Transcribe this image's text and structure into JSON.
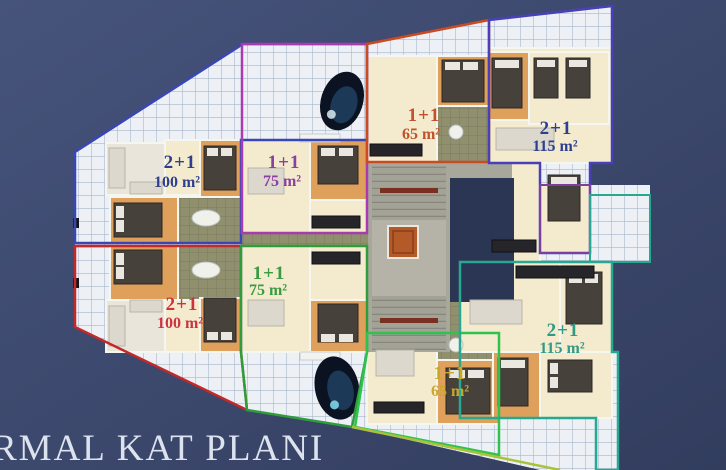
{
  "title": "RMAL KAT PLANI",
  "plan": {
    "units": [
      {
        "id": "top-left",
        "type": "2+1",
        "area": "100 m²",
        "label_color": "#2e3f8f",
        "outline_color": "#3847b5"
      },
      {
        "id": "top-mid-left",
        "type": "1+1",
        "area": "75 m²",
        "label_color": "#8b3fa0",
        "outline_color": "#a83bb0"
      },
      {
        "id": "top-mid-right",
        "type": "1+1",
        "area": "65 m²",
        "label_color": "#c0512a",
        "outline_color": "#cc4a22"
      },
      {
        "id": "top-right",
        "type": "2+1",
        "area": "115 m²",
        "label_color": "#2e3f8f",
        "outline_color": "#4840b8"
      },
      {
        "id": "bottom-left",
        "type": "2+1",
        "area": "100 m²",
        "label_color": "#cc3340",
        "outline_color": "#c42828"
      },
      {
        "id": "bottom-mid-left",
        "type": "1+1",
        "area": "75 m²",
        "label_color": "#3a9a40",
        "outline_color": "#2f9e3a"
      },
      {
        "id": "bottom-mid-right",
        "type": "1+1",
        "area": "65 m²",
        "label_color": "#c8a828",
        "outline_color": "#2ec24e"
      },
      {
        "id": "bottom-right",
        "type": "2+1",
        "area": "115 m²",
        "label_color": "#2f9a86",
        "outline_color": "#27a890"
      }
    ],
    "colors": {
      "background_top": "#46537b",
      "background_bottom": "#323d5e",
      "terrace_tile": "#edf1f6",
      "tile_line": "#a9b7cb",
      "room_cream": "#f4ebcf",
      "bedroom_orange": "#dfa05c",
      "bath_olive": "#90906f",
      "core_gray": "#a8a79b",
      "elevator_orange": "#b45a28",
      "void_navy": "#2b3554",
      "pool_dark": "#0b1322",
      "bottom_edge_green": "#a8c23a"
    }
  }
}
